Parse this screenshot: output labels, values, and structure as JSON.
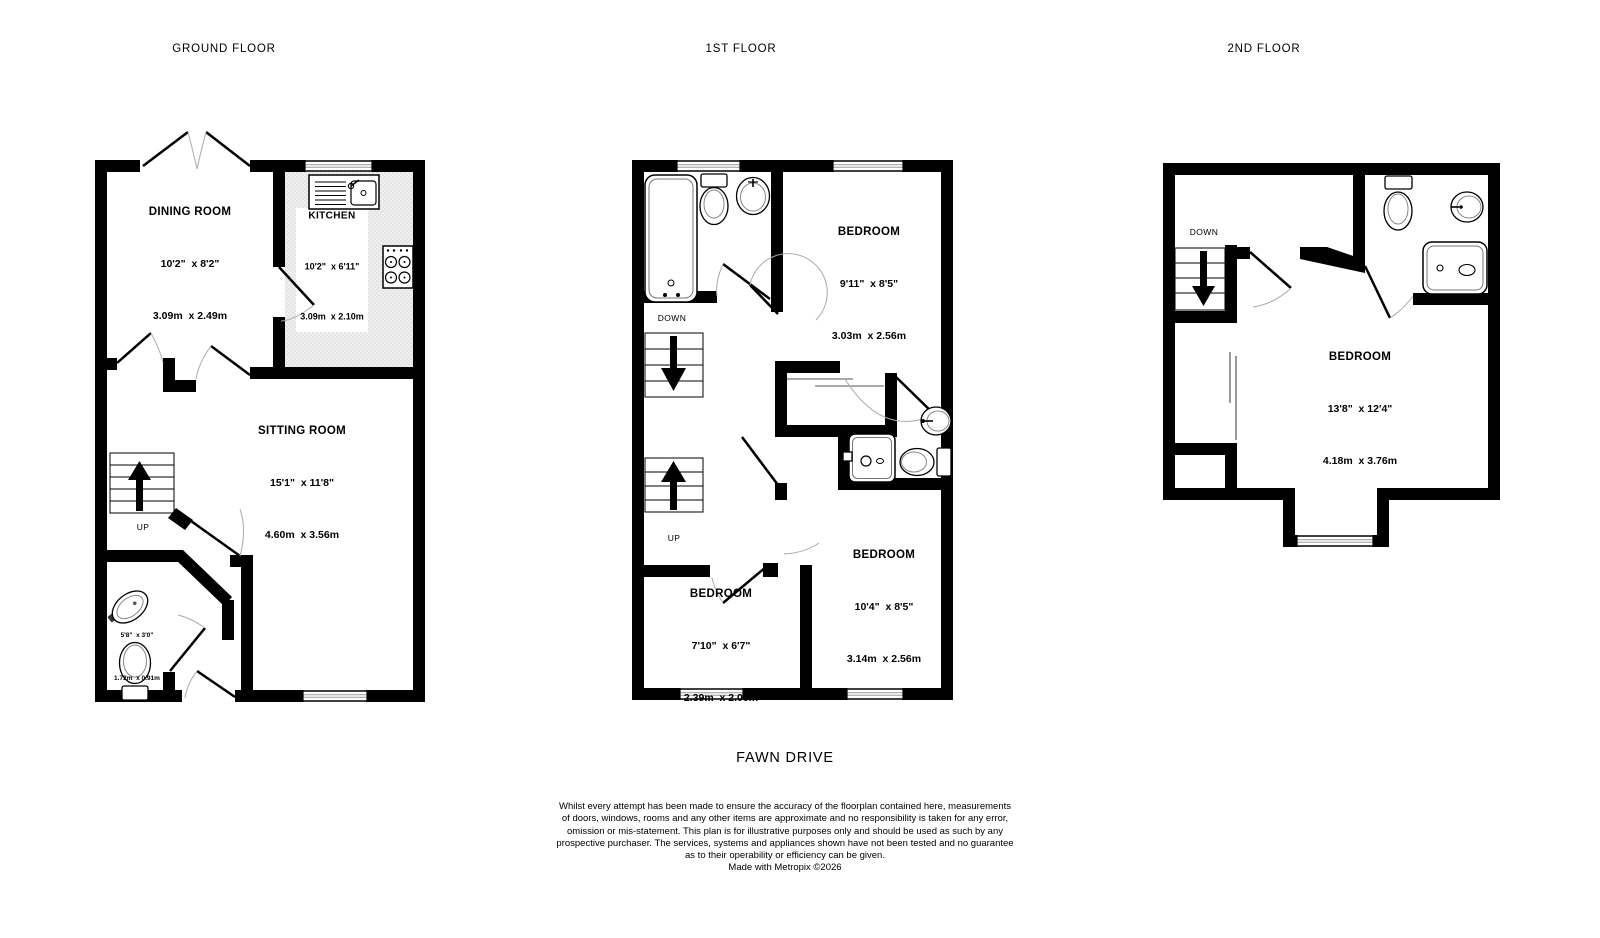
{
  "floors": [
    {
      "title": "GROUND FLOOR",
      "rooms": [
        {
          "name": "DINING ROOM",
          "imperial": "10'2\"  x 8'2\"",
          "metric": "3.09m  x 2.49m"
        },
        {
          "name": "KITCHEN",
          "imperial": "10'2\"  x 6'11\"",
          "metric": "3.09m  x 2.10m"
        },
        {
          "name": "SITTING ROOM",
          "imperial": "15'1\"  x 11'8\"",
          "metric": "4.60m  x 3.56m"
        },
        {
          "imperial": "5'8\"  x 3'0\"",
          "metric": "1.72m  x 0.91m"
        }
      ],
      "stair_labels": {
        "up": "UP"
      }
    },
    {
      "title": "1ST FLOOR",
      "rooms": [
        {
          "name": "BEDROOM",
          "imperial": "9'11\"  x 8'5\"",
          "metric": "3.03m  x 2.56m"
        },
        {
          "name": "BEDROOM",
          "imperial": "10'4\"  x 8'5\"",
          "metric": "3.14m  x 2.56m"
        },
        {
          "name": "BEDROOM",
          "imperial": "7'10\"  x 6'7\"",
          "metric": "2.39m  x 2.00m"
        }
      ],
      "stair_labels": {
        "down": "DOWN",
        "up": "UP"
      }
    },
    {
      "title": "2ND FLOOR",
      "rooms": [
        {
          "name": "BEDROOM",
          "imperial": "13'8\"  x 12'4\"",
          "metric": "4.18m  x 3.76m"
        }
      ],
      "stair_labels": {
        "down": "DOWN"
      }
    }
  ],
  "footer": {
    "address": "FAWN DRIVE",
    "disclaimer": [
      "Whilst every attempt has been made to ensure the accuracy of the floorplan contained here, measurements",
      "of doors, windows, rooms and any other items are approximate and no responsibility is taken for any error,",
      "omission or mis-statement. This plan is for illustrative purposes only and should be used as such by any",
      "prospective purchaser. The services, systems and appliances shown have not been tested and no guarantee",
      "as to their operability or efficiency can be given."
    ],
    "credit": "Made with Metropix ©2026"
  },
  "colors": {
    "wall": "#000000",
    "arc": "#aaaaaa",
    "fixture_inner": "#777777"
  }
}
